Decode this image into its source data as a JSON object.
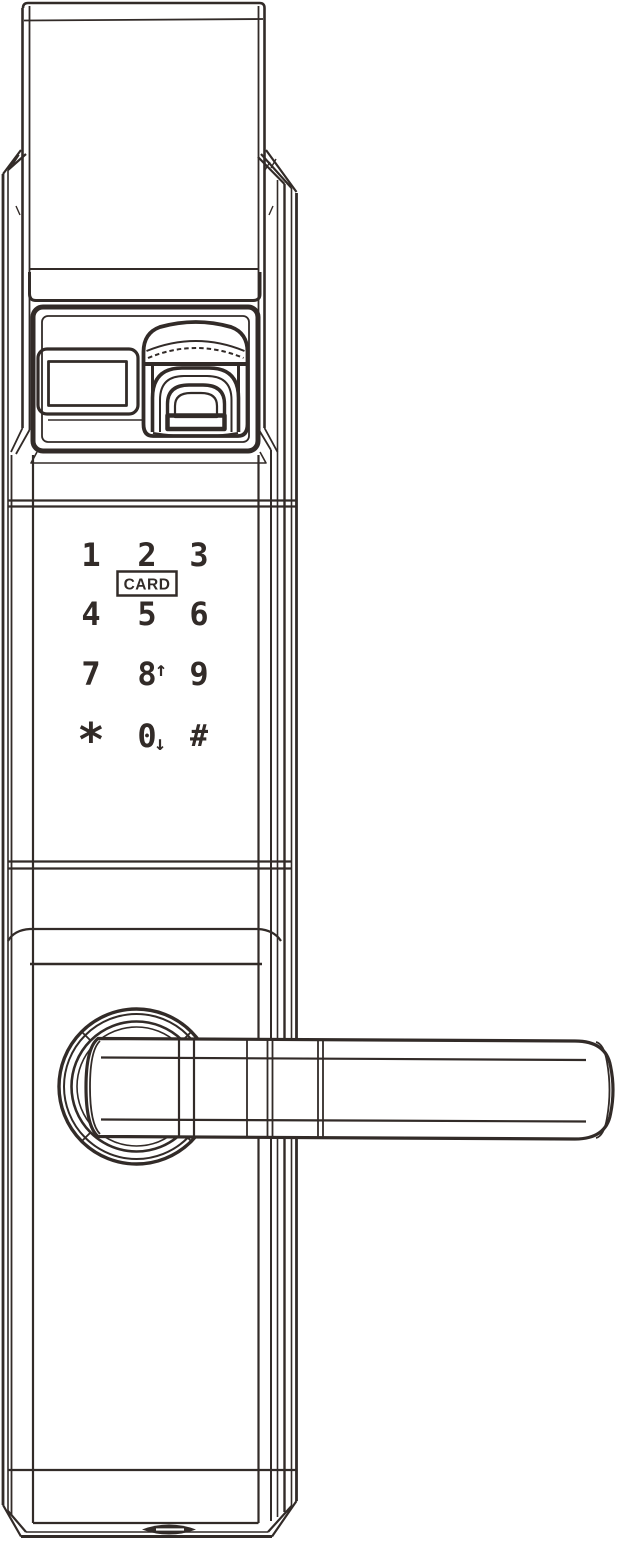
{
  "colors": {
    "line": "#322b28",
    "background": "#ffffff"
  },
  "keypad": {
    "keys": [
      {
        "label": "1"
      },
      {
        "label": "2"
      },
      {
        "label": "3"
      },
      {
        "label": "4"
      },
      {
        "label": "5"
      },
      {
        "label": "6"
      },
      {
        "label": "7"
      },
      {
        "label": "8"
      },
      {
        "label": "9"
      },
      {
        "label": "*"
      },
      {
        "label": "0"
      },
      {
        "label": "#"
      }
    ],
    "card_label": "CARD",
    "key8_annotation": "↑",
    "key0_annotation": "↓"
  }
}
